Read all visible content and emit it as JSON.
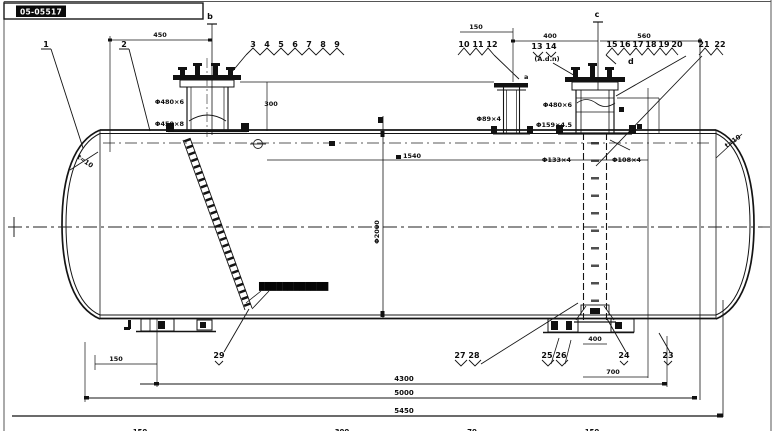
{
  "title_block": {
    "drawing_no": "05-05517"
  },
  "callouts": {
    "c1": "1",
    "c2": "2",
    "row_a": [
      "3",
      "4",
      "5",
      "6",
      "7",
      "8",
      "9"
    ],
    "row_b": [
      "10",
      "11",
      "12"
    ],
    "row_c": [
      "13",
      "14"
    ],
    "row_c_note": "(A.d.n)",
    "row_d": [
      "15",
      "16",
      "17",
      "18",
      "19",
      "20",
      "21",
      "22"
    ],
    "b_29": "29",
    "pair_27_28": [
      "27",
      "28"
    ],
    "pair_25_26": [
      "25",
      "26"
    ],
    "b_24": "24",
    "b_23": "23"
  },
  "section_marks": {
    "b": "b",
    "a": "a",
    "c": "c",
    "d": "d"
  },
  "dims": {
    "top_left": "450",
    "top_mid": "400",
    "top_right": "560",
    "nozzle_dim": "150",
    "neck_height": "300",
    "seam_span": "1540",
    "diameter": "Φ2000",
    "saddle_offset": "150",
    "pipe_width": "400",
    "saddle_span": "700",
    "len_a": "4300",
    "len_b": "5000",
    "len_c": "5450",
    "edge": [
      "150",
      "300",
      "70",
      "150"
    ]
  },
  "labels": {
    "manhole_upper": "Φ480×6",
    "manhole_lower": "Φ450×8",
    "small_nozzle": "Φ89×4",
    "riser_upper": "Φ480×6",
    "riser_lower": "Φ159×4.5",
    "riser_left_low": "Φ133×4",
    "riser_right_low": "Φ108×4",
    "head_left": "t=10",
    "head_right": "t=10",
    "ladder_note": "████████████"
  }
}
